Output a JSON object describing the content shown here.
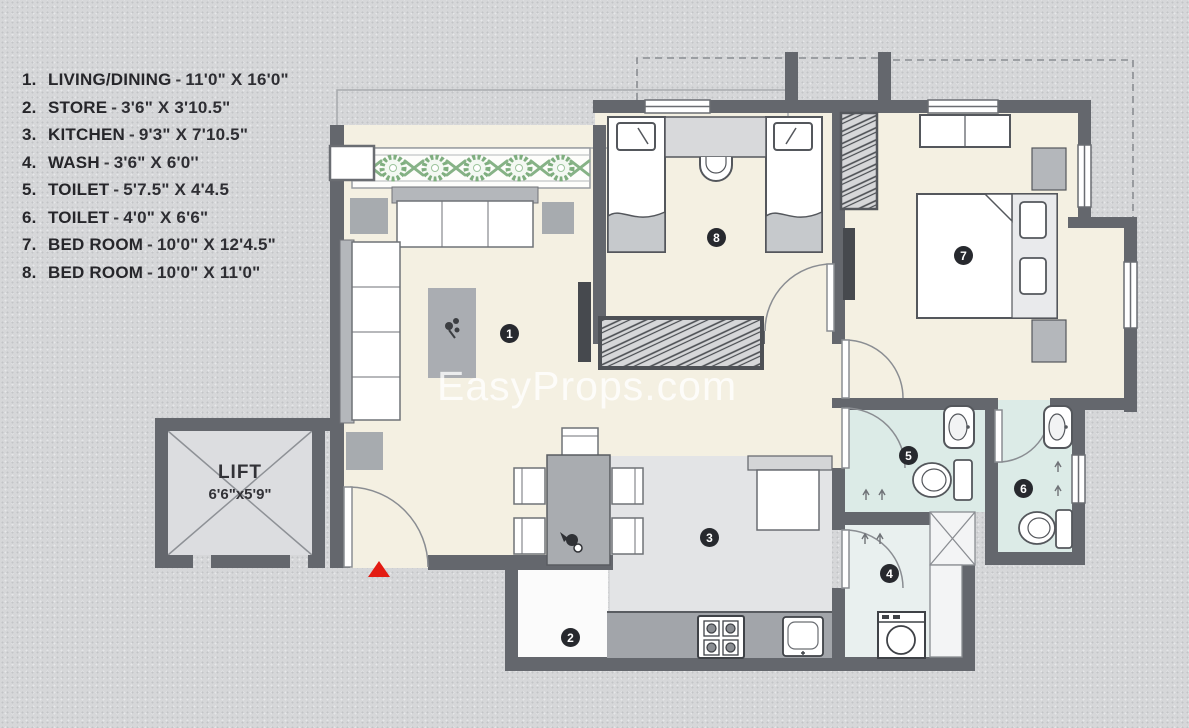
{
  "legend": {
    "dash": "-",
    "items": [
      {
        "num": "1.",
        "name": "LIVING/DINING",
        "dims": "11'0\" X 16'0\""
      },
      {
        "num": "2.",
        "name": "STORE",
        "dims": "3'6\" X 3'10.5\""
      },
      {
        "num": "3.",
        "name": "KITCHEN",
        "dims": "9'3\" X 7'10.5\""
      },
      {
        "num": "4.",
        "name": "WASH",
        "dims": "3'6\" X 6'0''"
      },
      {
        "num": "5.",
        "name": "TOILET",
        "dims": "5'7.5\" X 4'4.5"
      },
      {
        "num": "6.",
        "name": "TOILET",
        "dims": "4'0\" X 6'6\""
      },
      {
        "num": "7.",
        "name": "BED ROOM",
        "dims": "10'0\" X 12'4.5\""
      },
      {
        "num": "8.",
        "name": "BED ROOM",
        "dims": "10'0\" X 11'0\""
      }
    ]
  },
  "lift": {
    "label": "LIFT",
    "dims": "6'6\"x5'9\""
  },
  "room_badges": [
    "1",
    "2",
    "3",
    "4",
    "5",
    "6",
    "7",
    "8"
  ],
  "watermark": "EasyProps.com",
  "colors": {
    "wall": "#64676d",
    "floor_cream": "#f4f0e2",
    "floor_kitchen": "#e3e4e6",
    "floor_toilet": "#dcebe7",
    "floor_wash": "#e9f0ef",
    "counter_gray": "#a2a5aa",
    "plant_green": "#7fae7f",
    "entrance_red": "#e31b12",
    "badge_bg": "#27292e"
  }
}
